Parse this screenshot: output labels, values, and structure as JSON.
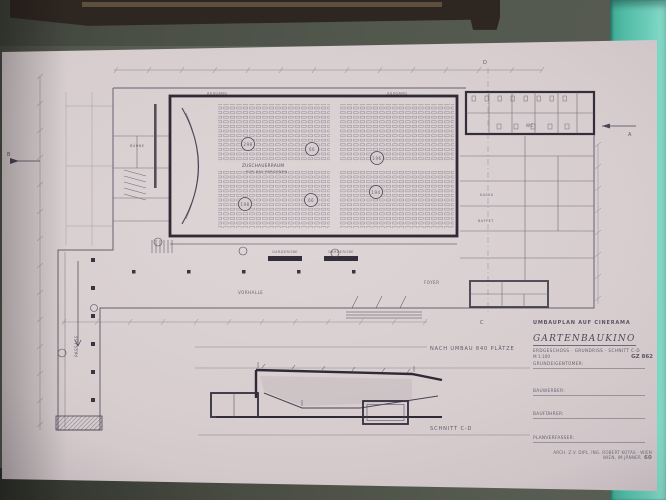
{
  "photo": {
    "colors": {
      "wall": "#646a5e",
      "frame_wood": "#2e2620",
      "teal_panel": "#5ac5af",
      "paper": "#d7cdcf",
      "ink": "#524c5e",
      "ink_heavy": "#332e3a"
    }
  },
  "title_block": {
    "project": "UMBAUPLAN AUF CINERAMA",
    "name": "GARTENBAUKINO",
    "sheet": "ERDGESCHOSS · GRUNDRISS · SCHNITT C-D",
    "scale": "M 1:100",
    "plan_no": "GZ 862"
  },
  "signature_block": {
    "lines": [
      "GRUNDEIGENTÜMER:",
      "BAUWERBER:",
      "BAUFÜHRER:",
      "PLANVERFASSER:"
    ]
  },
  "stamp": {
    "line1": "ARCH. Z.V. DIPL. ING. ROBERT KOTAS · WIEN",
    "line2": "WIEN, IM JÄNNER",
    "number": "60"
  },
  "plan": {
    "auditorium_label": "ZUSCHAUERRAUM",
    "auditorium_sub": "FÜR 840 PERSONEN",
    "seat_blocks": [
      "298",
      "66",
      "196",
      "198",
      "66",
      "194"
    ],
    "note": "NACH UMBAU 840 PLÄTZE",
    "room_labels": {
      "ausgang1": "AUSGANG",
      "ausgang2": "AUSGANG",
      "wc": "WC",
      "kassa": "KASSA",
      "buffet": "BUFFET",
      "buehne": "BÜHNE",
      "garderobe1": "GARDEROBE",
      "garderobe2": "GARDEROBE",
      "vorhalle": "VORHALLE",
      "foyer": "FOYER",
      "passage": "PASSAGE"
    },
    "markers": {
      "a": "A",
      "b": "B",
      "c": "C",
      "d": "D"
    }
  },
  "section": {
    "label": "SCHNITT C-D"
  }
}
